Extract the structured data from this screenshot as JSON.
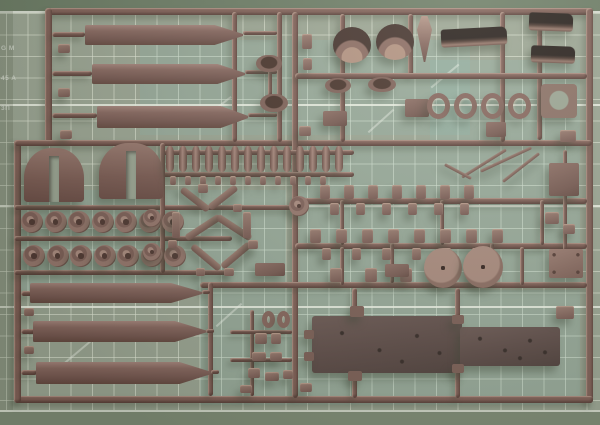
{
  "scene": {
    "subject": "dark brown plastic model-kit sprue (parts tree) photographed on a green cutting mat",
    "photo_width": 600,
    "photo_height": 425
  },
  "mat": {
    "base_color": "#9aa492",
    "grid_line_color": "rgba(226,232,216,0.6)",
    "major_line_color": "rgba(240,244,232,0.85)",
    "tint_color": "rgba(130,195,188,0.16)",
    "top_strip_color": "#6a7a63",
    "bottom_strip_color": "#7d8a74",
    "cell_size_px": 21.5,
    "edge_text": {
      "line1": "G M",
      "line2": "45 A",
      "line3": "3П"
    }
  },
  "sprue": {
    "plastic_color": "#7f5f56",
    "plastic_highlight": "#a8867c",
    "plastic_shadow": "#5f443e",
    "dark_part_color": "#241c18",
    "runners": [
      [
        48,
        8,
        545,
        7
      ],
      [
        586,
        8,
        7,
        395
      ],
      [
        16,
        396,
        577,
        7
      ],
      [
        45,
        8,
        7,
        138
      ],
      [
        14,
        140,
        7,
        263
      ],
      [
        14,
        140,
        578,
        6
      ],
      [
        292,
        12,
        6,
        386
      ],
      [
        232,
        12,
        5,
        130
      ],
      [
        277,
        12,
        5,
        130
      ],
      [
        340,
        14,
        5,
        128
      ],
      [
        408,
        14,
        5,
        62
      ],
      [
        500,
        12,
        5,
        130
      ],
      [
        537,
        14,
        5,
        126
      ],
      [
        295,
        73,
        292,
        6
      ],
      [
        295,
        198,
        292,
        6
      ],
      [
        295,
        243,
        292,
        6
      ],
      [
        200,
        282,
        387,
        6
      ],
      [
        14,
        205,
        280,
        5
      ],
      [
        14,
        236,
        218,
        5
      ],
      [
        14,
        270,
        218,
        5
      ],
      [
        162,
        150,
        192,
        5
      ],
      [
        162,
        172,
        192,
        5
      ],
      [
        160,
        143,
        5,
        130
      ],
      [
        208,
        282,
        5,
        114
      ],
      [
        250,
        310,
        4,
        86
      ],
      [
        230,
        330,
        62,
        4
      ],
      [
        230,
        358,
        62,
        4
      ],
      [
        340,
        200,
        4,
        45
      ],
      [
        440,
        200,
        4,
        45
      ],
      [
        540,
        200,
        4,
        45
      ],
      [
        390,
        243,
        4,
        40
      ],
      [
        490,
        243,
        4,
        40
      ],
      [
        340,
        247,
        4,
        38
      ],
      [
        520,
        247,
        4,
        38
      ],
      [
        352,
        288,
        5,
        30
      ],
      [
        455,
        288,
        5,
        30
      ],
      [
        352,
        372,
        5,
        26
      ],
      [
        455,
        366,
        5,
        32
      ],
      [
        52,
        32,
        33,
        5
      ],
      [
        52,
        71,
        40,
        5
      ],
      [
        52,
        113,
        45,
        5
      ],
      [
        21,
        291,
        12,
        5
      ],
      [
        21,
        329,
        14,
        5
      ],
      [
        21,
        370,
        16,
        5
      ],
      [
        243,
        31,
        34,
        4
      ],
      [
        245,
        70,
        32,
        4
      ],
      [
        248,
        113,
        29,
        4
      ],
      [
        202,
        290,
        8,
        4
      ],
      [
        206,
        329,
        8,
        4
      ],
      [
        211,
        370,
        8,
        4
      ],
      [
        440,
        250,
        4,
        10
      ],
      [
        478,
        248,
        4,
        10
      ],
      [
        268,
        60,
        4,
        36
      ],
      [
        563,
        150,
        4,
        100
      ]
    ],
    "parts": [
      {
        "n": "hull-side-bar",
        "s": "bar",
        "x": 85,
        "y": 25,
        "w": 158,
        "h": 20
      },
      {
        "n": "hull-side-bar",
        "s": "bar",
        "x": 92,
        "y": 64,
        "w": 153,
        "h": 20
      },
      {
        "n": "hull-side-bar",
        "s": "bar",
        "x": 97,
        "y": 106,
        "w": 151,
        "h": 22
      },
      {
        "n": "hull-side-bar",
        "s": "bar",
        "x": 30,
        "y": 283,
        "w": 172,
        "h": 20
      },
      {
        "n": "hull-side-bar",
        "s": "bar",
        "x": 33,
        "y": 321,
        "w": 173,
        "h": 21
      },
      {
        "n": "hull-side-bar",
        "s": "bar",
        "x": 36,
        "y": 362,
        "w": 175,
        "h": 22
      },
      {
        "n": "fender-arch",
        "s": "arch",
        "x": 24,
        "y": 148,
        "w": 60,
        "h": 54
      },
      {
        "n": "fender-arch",
        "s": "arch",
        "x": 99,
        "y": 143,
        "w": 64,
        "h": 56
      },
      {
        "n": "road-wheel",
        "s": "wheel",
        "x": 21,
        "y": 211,
        "w": 22,
        "h": 22,
        "c": 7,
        "dx": 23.5
      },
      {
        "n": "road-wheel",
        "s": "wheel",
        "x": 23,
        "y": 245,
        "w": 22,
        "h": 22,
        "c": 7,
        "dx": 23.5
      },
      {
        "n": "suspension-pin",
        "s": "pin",
        "x": 166,
        "y": 146,
        "w": 8,
        "h": 26,
        "c": 14,
        "dx": 13
      },
      {
        "n": "small-fitting",
        "s": "nub",
        "x": 170,
        "y": 176,
        "w": 6,
        "h": 9,
        "c": 11,
        "dx": 15
      },
      {
        "n": "small-wheel",
        "s": "wheel",
        "x": 143,
        "y": 209,
        "w": 18,
        "h": 18
      },
      {
        "n": "small-wheel",
        "s": "wheel",
        "x": 143,
        "y": 243,
        "w": 18,
        "h": 18
      },
      {
        "n": "suspension-arm",
        "s": "arm",
        "x": 178,
        "y": 196,
        "w": 34,
        "h": 7,
        "r": 38
      },
      {
        "n": "suspension-arm",
        "s": "arm",
        "x": 206,
        "y": 194,
        "w": 34,
        "h": 7,
        "r": -38
      },
      {
        "n": "suspension-arm",
        "s": "arm",
        "x": 183,
        "y": 224,
        "w": 40,
        "h": 7,
        "r": -33
      },
      {
        "n": "suspension-arm",
        "s": "arm",
        "x": 214,
        "y": 224,
        "w": 40,
        "h": 7,
        "r": 33
      },
      {
        "n": "suspension-arm",
        "s": "arm",
        "x": 188,
        "y": 254,
        "w": 36,
        "h": 7,
        "r": 40
      },
      {
        "n": "suspension-arm",
        "s": "arm",
        "x": 218,
        "y": 252,
        "w": 36,
        "h": 7,
        "r": -40
      },
      {
        "n": "suspension-link",
        "s": "nub",
        "x": 172,
        "y": 212,
        "w": 8,
        "h": 26
      },
      {
        "n": "suspension-link",
        "s": "nub",
        "x": 243,
        "y": 212,
        "w": 8,
        "h": 26
      },
      {
        "n": "small-fitting",
        "s": "nub",
        "x": 198,
        "y": 184,
        "w": 10,
        "h": 9
      },
      {
        "n": "small-fitting",
        "s": "nub",
        "x": 233,
        "y": 204,
        "w": 9,
        "h": 8
      },
      {
        "n": "small-fitting",
        "s": "nub",
        "x": 168,
        "y": 240,
        "w": 9,
        "h": 8
      },
      {
        "n": "small-fitting",
        "s": "nub",
        "x": 248,
        "y": 240,
        "w": 10,
        "h": 9
      },
      {
        "n": "small-fitting",
        "s": "nub",
        "x": 224,
        "y": 268,
        "w": 10,
        "h": 8
      },
      {
        "n": "small-fitting",
        "s": "nub",
        "x": 196,
        "y": 268,
        "w": 9,
        "h": 8
      },
      {
        "n": "pulley-wheel",
        "s": "wheel",
        "x": 289,
        "y": 196,
        "w": 20,
        "h": 20
      },
      {
        "n": "stowage-pod",
        "s": "pod",
        "x": 256,
        "y": 55,
        "w": 26,
        "h": 17
      },
      {
        "n": "stowage-pod",
        "s": "pod",
        "x": 260,
        "y": 94,
        "w": 28,
        "h": 18
      },
      {
        "n": "small-bracket",
        "s": "nub",
        "x": 302,
        "y": 34,
        "w": 10,
        "h": 15
      },
      {
        "n": "small-bracket",
        "s": "nub",
        "x": 303,
        "y": 58,
        "w": 9,
        "h": 12
      },
      {
        "n": "access-plate",
        "s": "plate",
        "x": 323,
        "y": 111,
        "w": 24,
        "h": 15
      },
      {
        "n": "small-bracket",
        "s": "nub",
        "x": 299,
        "y": 126,
        "w": 12,
        "h": 10
      },
      {
        "n": "half-shell",
        "s": "cup",
        "x": 333,
        "y": 27,
        "w": 38,
        "h": 36
      },
      {
        "n": "half-shell",
        "s": "cup",
        "x": 376,
        "y": 24,
        "w": 38,
        "h": 36
      },
      {
        "n": "blade-part",
        "s": "teardrop",
        "x": 417,
        "y": 16,
        "w": 15,
        "h": 46
      },
      {
        "n": "equipment-box",
        "s": "plate",
        "x": 405,
        "y": 99,
        "w": 24,
        "h": 18
      },
      {
        "n": "fender-channel",
        "s": "channel",
        "x": 441,
        "y": 28,
        "w": 66,
        "h": 18,
        "r": -3
      },
      {
        "n": "fender-channel",
        "s": "channel",
        "x": 529,
        "y": 13,
        "w": 44,
        "h": 18,
        "r": 2
      },
      {
        "n": "fender-channel",
        "s": "channel",
        "x": 531,
        "y": 46,
        "w": 44,
        "h": 17,
        "r": 2
      },
      {
        "n": "stowage-tub",
        "s": "pod",
        "x": 325,
        "y": 78,
        "w": 26,
        "h": 15
      },
      {
        "n": "stowage-tub",
        "s": "pod",
        "x": 368,
        "y": 77,
        "w": 28,
        "h": 15
      },
      {
        "n": "hatch-ring",
        "s": "ring",
        "x": 427,
        "y": 93,
        "w": 23,
        "h": 26,
        "c": 4,
        "dx": 27
      },
      {
        "n": "hatch-plate-with-hole",
        "s": "holeplate",
        "x": 541,
        "y": 84,
        "w": 36,
        "h": 34
      },
      {
        "n": "small-hatch",
        "s": "plate",
        "x": 486,
        "y": 122,
        "w": 20,
        "h": 15
      },
      {
        "n": "equipment-plate",
        "s": "plate",
        "x": 549,
        "y": 163,
        "w": 30,
        "h": 33
      },
      {
        "n": "riveted-hatch",
        "s": "riveted",
        "x": 549,
        "y": 249,
        "w": 34,
        "h": 29
      },
      {
        "n": "antenna-mast",
        "s": "arm",
        "x": 458,
        "y": 162,
        "w": 52,
        "h": 3,
        "r": -32
      },
      {
        "n": "antenna-mast",
        "s": "arm",
        "x": 478,
        "y": 158,
        "w": 56,
        "h": 3,
        "r": -25
      },
      {
        "n": "antenna-mast",
        "s": "arm",
        "x": 498,
        "y": 166,
        "w": 46,
        "h": 3,
        "r": -38
      },
      {
        "n": "antenna-mast",
        "s": "arm",
        "x": 443,
        "y": 170,
        "w": 30,
        "h": 3,
        "r": 28
      },
      {
        "n": "small-fitting",
        "s": "nub",
        "x": 320,
        "y": 185,
        "w": 10,
        "h": 14,
        "c": 7,
        "dx": 24
      },
      {
        "n": "small-fitting",
        "s": "nub",
        "x": 330,
        "y": 203,
        "w": 9,
        "h": 12,
        "c": 6,
        "dx": 26
      },
      {
        "n": "small-fitting",
        "s": "nub",
        "x": 310,
        "y": 229,
        "w": 11,
        "h": 14,
        "c": 8,
        "dx": 26
      },
      {
        "n": "small-fitting",
        "s": "nub",
        "x": 322,
        "y": 248,
        "w": 9,
        "h": 12,
        "c": 6,
        "dx": 30
      },
      {
        "n": "small-fitting",
        "s": "nub",
        "x": 330,
        "y": 268,
        "w": 12,
        "h": 14,
        "c": 5,
        "dx": 35
      },
      {
        "n": "bracket-trapezoid",
        "s": "plate",
        "x": 255,
        "y": 263,
        "w": 30,
        "h": 13
      },
      {
        "n": "bracket-wide",
        "s": "plate",
        "x": 385,
        "y": 264,
        "w": 24,
        "h": 13
      },
      {
        "n": "sprocket-disc",
        "s": "disc",
        "x": 424,
        "y": 248,
        "w": 38,
        "h": 40
      },
      {
        "n": "sprocket-disc",
        "s": "disc",
        "x": 463,
        "y": 246,
        "w": 40,
        "h": 42
      },
      {
        "n": "hull-floor-plate",
        "s": "hull",
        "x": 312,
        "y": 316,
        "w": 150,
        "h": 57
      },
      {
        "n": "hull-floor-plate",
        "s": "hull",
        "x": 460,
        "y": 327,
        "w": 100,
        "h": 39
      },
      {
        "n": "hull-tab",
        "s": "tab",
        "x": 350,
        "y": 306,
        "w": 14,
        "h": 11
      },
      {
        "n": "hull-tab",
        "s": "tab",
        "x": 452,
        "y": 315,
        "w": 12,
        "h": 9
      },
      {
        "n": "hull-tab",
        "s": "tab",
        "x": 348,
        "y": 371,
        "w": 14,
        "h": 10
      },
      {
        "n": "hull-tab",
        "s": "tab",
        "x": 452,
        "y": 364,
        "w": 12,
        "h": 9
      },
      {
        "n": "hull-tab",
        "s": "tab",
        "x": 304,
        "y": 330,
        "w": 10,
        "h": 9
      },
      {
        "n": "hull-tab",
        "s": "tab",
        "x": 304,
        "y": 352,
        "w": 10,
        "h": 9
      },
      {
        "n": "tow-loop",
        "s": "ring",
        "x": 262,
        "y": 311,
        "w": 13,
        "h": 17
      },
      {
        "n": "tow-loop",
        "s": "ring",
        "x": 277,
        "y": 311,
        "w": 13,
        "h": 17
      },
      {
        "n": "small-fitting",
        "s": "nub",
        "x": 255,
        "y": 333,
        "w": 12,
        "h": 11
      },
      {
        "n": "small-fitting",
        "s": "nub",
        "x": 271,
        "y": 333,
        "w": 10,
        "h": 11
      },
      {
        "n": "small-fitting",
        "s": "nub",
        "x": 252,
        "y": 352,
        "w": 14,
        "h": 9
      },
      {
        "n": "small-fitting",
        "s": "nub",
        "x": 270,
        "y": 352,
        "w": 12,
        "h": 9
      },
      {
        "n": "small-fitting",
        "s": "nub",
        "x": 248,
        "y": 368,
        "w": 12,
        "h": 10
      },
      {
        "n": "small-fitting",
        "s": "nub",
        "x": 265,
        "y": 372,
        "w": 14,
        "h": 9
      },
      {
        "n": "small-fitting",
        "s": "nub",
        "x": 283,
        "y": 370,
        "w": 10,
        "h": 9
      },
      {
        "n": "small-fitting",
        "s": "nub",
        "x": 240,
        "y": 385,
        "w": 12,
        "h": 8
      },
      {
        "n": "small-fitting",
        "s": "nub",
        "x": 300,
        "y": 383,
        "w": 12,
        "h": 9
      },
      {
        "n": "rail-fitting",
        "s": "nub",
        "x": 560,
        "y": 130,
        "w": 16,
        "h": 12
      },
      {
        "n": "rail-fitting",
        "s": "nub",
        "x": 545,
        "y": 212,
        "w": 14,
        "h": 12
      },
      {
        "n": "rail-fitting",
        "s": "nub",
        "x": 563,
        "y": 224,
        "w": 12,
        "h": 10
      },
      {
        "n": "rail-fitting",
        "s": "nub",
        "x": 556,
        "y": 306,
        "w": 18,
        "h": 13
      },
      {
        "n": "gate-stub",
        "s": "nub",
        "x": 58,
        "y": 44,
        "w": 12,
        "h": 9
      },
      {
        "n": "gate-stub",
        "s": "nub",
        "x": 58,
        "y": 88,
        "w": 12,
        "h": 9
      },
      {
        "n": "gate-stub",
        "s": "nub",
        "x": 60,
        "y": 130,
        "w": 12,
        "h": 9
      },
      {
        "n": "gate-stub",
        "s": "nub",
        "x": 24,
        "y": 308,
        "w": 10,
        "h": 8
      },
      {
        "n": "gate-stub",
        "s": "nub",
        "x": 24,
        "y": 346,
        "w": 10,
        "h": 8
      }
    ]
  }
}
